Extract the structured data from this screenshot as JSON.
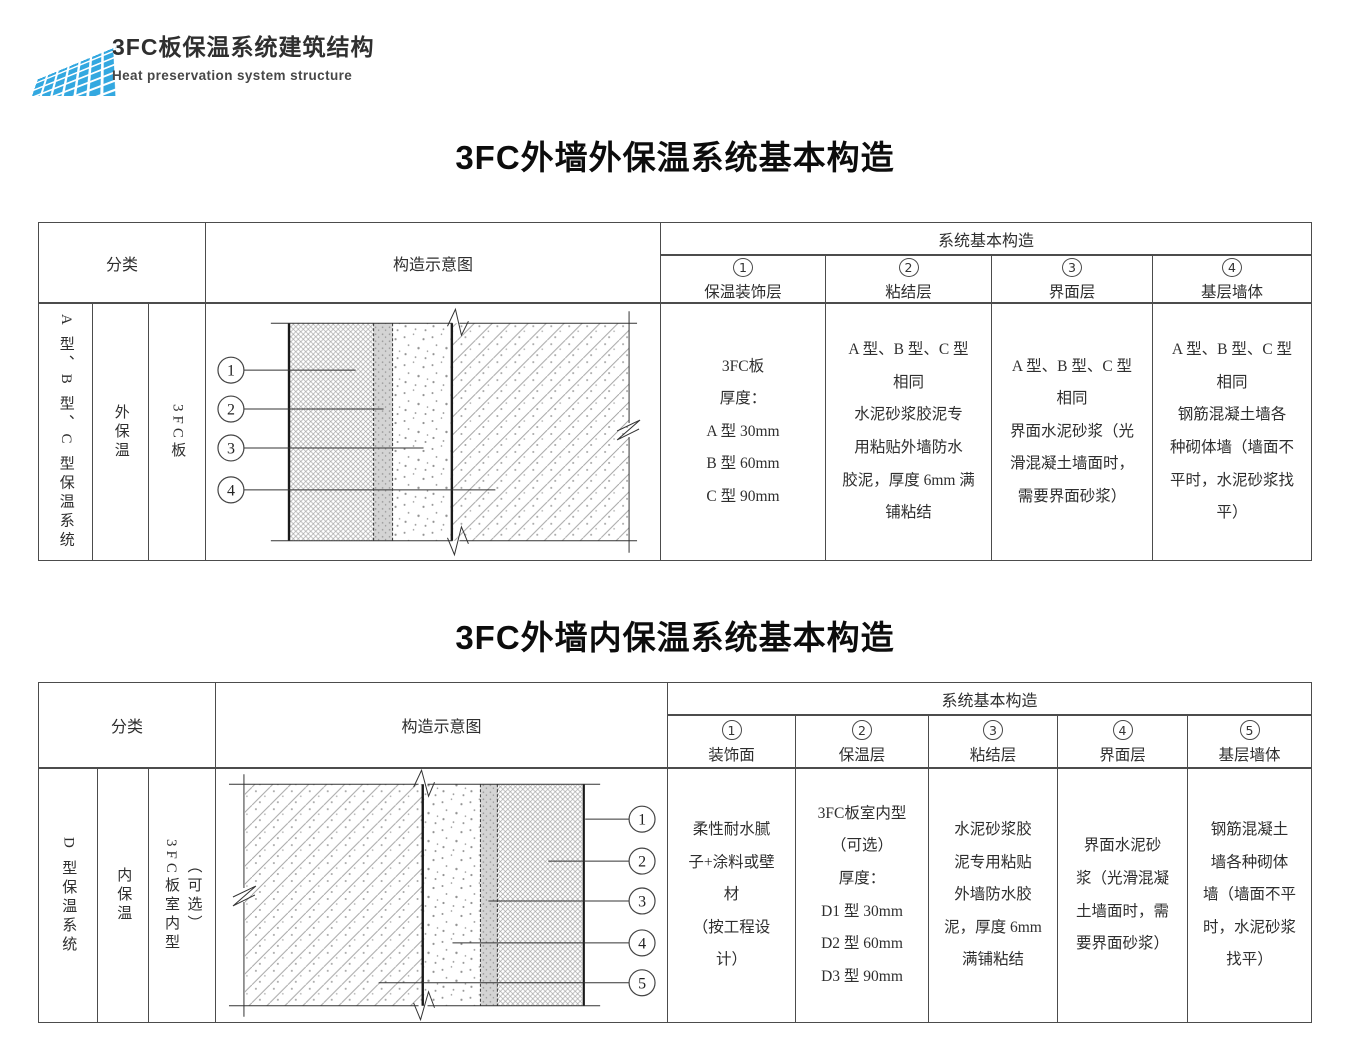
{
  "brand": {
    "logo_color": "#33a8e0",
    "title": "3FC板保温系统建筑结构",
    "subtitle": "Heat preservation system structure"
  },
  "section1": {
    "title": "3FC外墙外保温系统基本构造",
    "table": {
      "header": {
        "classification": "分类",
        "diagram": "构造示意图",
        "system": "系统基本构造",
        "columns": [
          {
            "num": "1",
            "label": "保温装饰层"
          },
          {
            "num": "2",
            "label": "粘结层"
          },
          {
            "num": "3",
            "label": "界面层"
          },
          {
            "num": "4",
            "label": "基层墙体"
          }
        ]
      },
      "row": {
        "category": "A 型、B 型、C 型保温系统",
        "position": "外保温",
        "board": "3FC板"
      },
      "cells": [
        "3FC板\n厚度：\nA 型 30mm\nB 型 60mm\nC 型 90mm",
        "A 型、B 型、C 型\n相同\n水泥砂浆胶泥专\n用粘贴外墙防水\n胶泥，厚度 6mm 满\n铺粘结",
        "A 型、B 型、C 型\n相同\n界面水泥砂浆（光\n滑混凝土墙面时，\n需要界面砂浆）",
        "A 型、B 型、C 型\n相同\n钢筋混凝土墙各\n种砌体墙（墙面不\n平时，水泥砂浆找\n平）"
      ],
      "callouts": [
        "1",
        "2",
        "3",
        "4"
      ]
    }
  },
  "section2": {
    "title": "3FC外墙内保温系统基本构造",
    "table": {
      "header": {
        "classification": "分类",
        "diagram": "构造示意图",
        "system": "系统基本构造",
        "columns": [
          {
            "num": "1",
            "label": "装饰面"
          },
          {
            "num": "2",
            "label": "保温层"
          },
          {
            "num": "3",
            "label": "粘结层"
          },
          {
            "num": "4",
            "label": "界面层"
          },
          {
            "num": "5",
            "label": "基层墙体"
          }
        ]
      },
      "row": {
        "category": "D 型保温系统",
        "position": "内保温",
        "board": "3FC板室内型",
        "board_note": "（可选）"
      },
      "cells": [
        "柔性耐水腻\n子+涂料或壁\n材\n（按工程设\n计）",
        "3FC板室内型\n（可选）\n厚度：\nD1 型 30mm\nD2 型 60mm\nD3 型 90mm",
        "水泥砂浆胶\n泥专用粘贴\n外墙防水胶\n泥，厚度 6mm\n满铺粘结",
        "界面水泥砂\n浆（光滑混凝\n土墙面时，需\n要界面砂浆）",
        "钢筋混凝土\n墙各种砌体\n墙（墙面不平\n时，水泥砂浆\n找平）"
      ],
      "callouts": [
        "1",
        "2",
        "3",
        "4",
        "5"
      ]
    }
  }
}
